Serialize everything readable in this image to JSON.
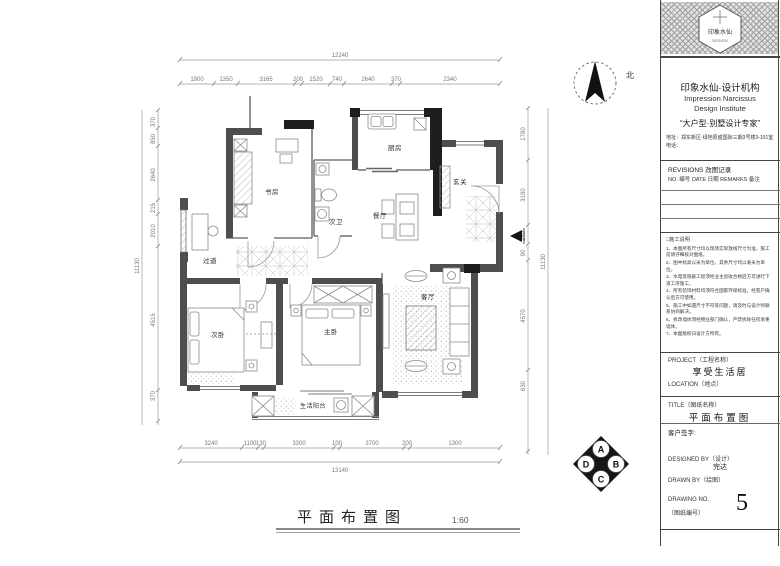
{
  "panel": {
    "logo_text": "印象水仙",
    "logo_sub": "DESIGN",
    "company_cn": "印象水仙·设计机构",
    "company_en1": "Impression Narcissus",
    "company_en2": "Design Institute",
    "slogan": "“大户型·别墅设计专家”",
    "address_line1": "地址：郑东新区·绿地原盛国际三期3号楼3-101室",
    "address_line2": "电话：",
    "revisions_title": "REVISIONS 改图记录",
    "revisions_header": "NO. 编号   DATE 日期   REMARKS 备注",
    "notes_title": "□施工说明",
    "notes": [
      "1、本图所有尺寸均以现场实际放线尺寸为准，施工前请仔细核对图纸。",
      "2、图中标高以米为单位，其余尺寸均以毫米为单位。",
      "3、水电等隐蔽工程须经业主验收合格后方可进行下道工序施工。",
      "4、所有装饰材料均须符合国家环保标准，经客户确认后方可使用。",
      "5、施工中如遇尺寸不符等问题，请及时与设计师联系协商解决。",
      "6、拆改墙体须经物业部门确认，严禁拆除任何承重墙体。",
      "7、本图版权归设计方所有。"
    ],
    "project_label": "PROJECT（工程名称）",
    "project_name": "享受生活居",
    "location_label": "LOCATION（地点）",
    "title_label": "TITLE（图纸名称）",
    "sheet_title": "平面布置图",
    "client_sign": "客户签字:",
    "designed_by_label": "DESIGNED BY（设计）",
    "designer_name": "完达",
    "drawn_by_label": "DRAWN BY（绘图）",
    "drawing_no_label": "DRAWING NO.",
    "drawing_no_label2": "（图纸编号）",
    "drawing_no": "5"
  },
  "plan": {
    "title": "平面布置图",
    "scale": "1:60",
    "north_label": "北",
    "rooms": {
      "study": "书房",
      "bath2": "次卫",
      "kitchen": "厨房",
      "dining": "餐厅",
      "entry": "玄关",
      "corridor": "过道",
      "bed2": "次卧",
      "bed1": "主卧",
      "living": "客厅",
      "balcony": "生活阳台"
    },
    "index_symbol": {
      "a": "A",
      "b": "B",
      "c": "C",
      "d": "D"
    },
    "dims": {
      "top_overall": "12240",
      "top": [
        "1900",
        "1350",
        "3165",
        "200",
        "1520",
        "740",
        "2640",
        "370",
        "2340"
      ],
      "bottom": [
        "3240",
        "1100",
        "130",
        "3300",
        "100",
        "3700",
        "200",
        "1300"
      ],
      "bottom_overall": "13140",
      "left": [
        "370",
        "850",
        "2640",
        "215",
        "2010",
        "4515",
        "370"
      ],
      "left_overall": "11130",
      "right": [
        "1780",
        "3190",
        "240",
        "90",
        "4570",
        "630"
      ],
      "right_overall": "11130"
    }
  }
}
